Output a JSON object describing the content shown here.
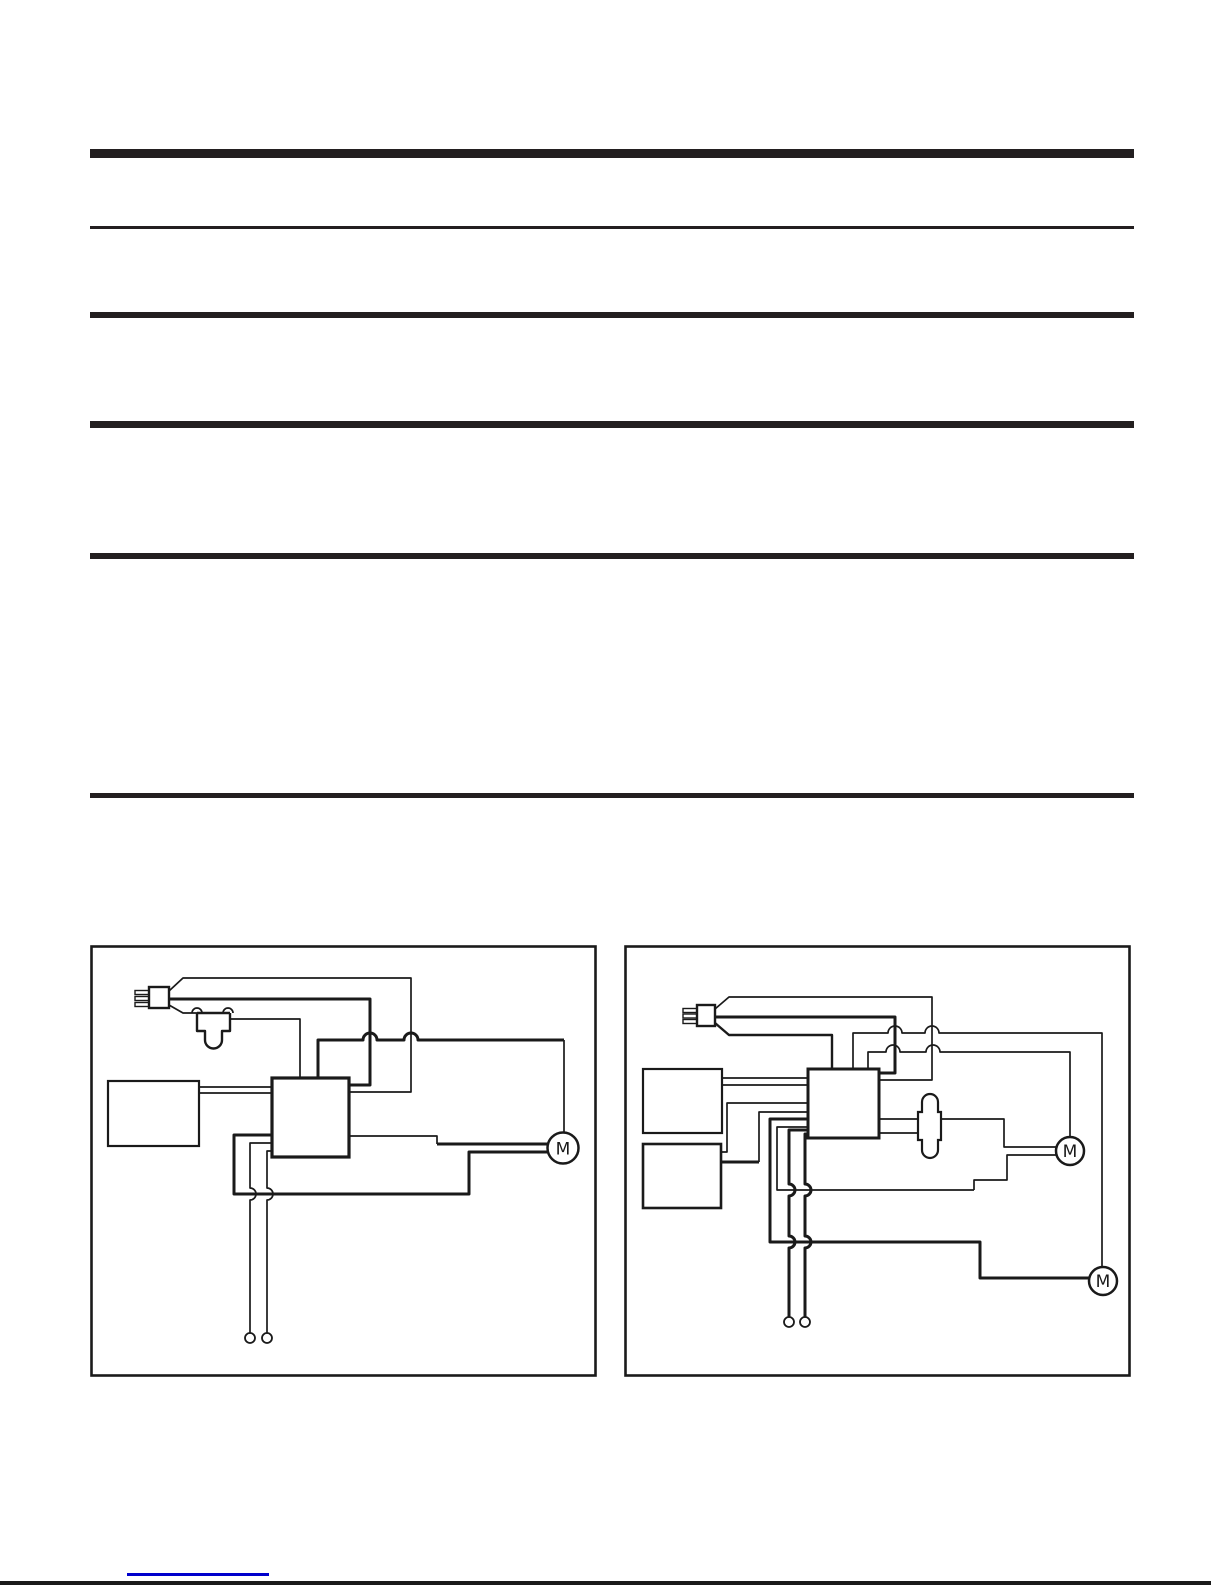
{
  "document": {
    "colors": {
      "paper": "#ffffff",
      "ink": "#1a1a1a",
      "rule": "#231f20",
      "link_underline": "#0000cc"
    }
  },
  "diagrams": {
    "left": {
      "motors": [
        "M"
      ]
    },
    "right": {
      "motors": [
        "M",
        "M"
      ]
    }
  }
}
